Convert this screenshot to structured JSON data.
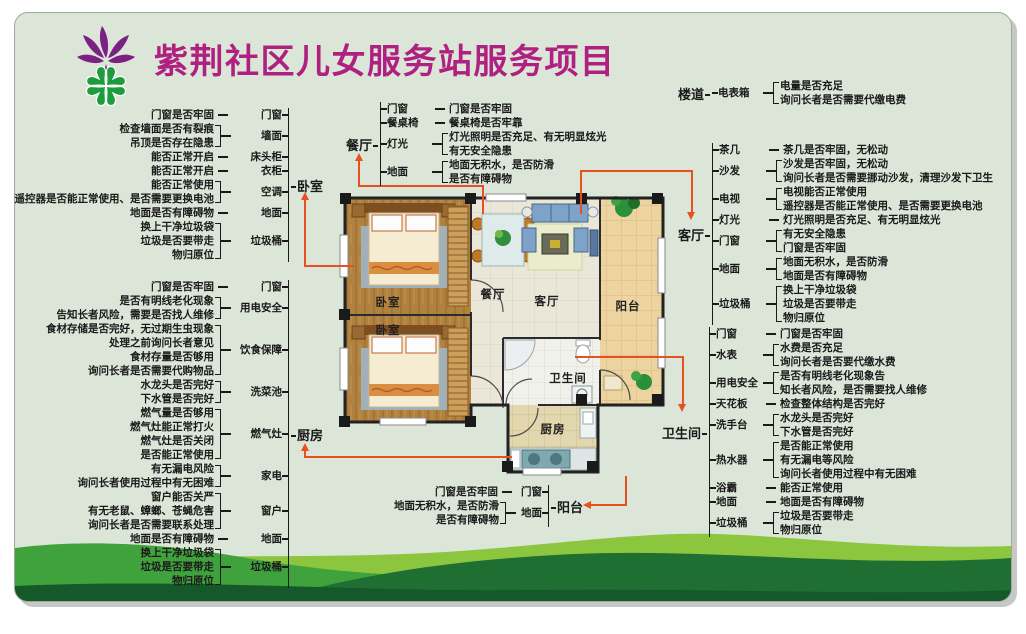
{
  "title": "紫荆社区儿女服务站服务项目",
  "colors": {
    "title": "#AF2080",
    "connector": "#E8511F",
    "poster_background": "#DBE6D8",
    "hills": [
      "#8CC63E",
      "#40A23C",
      "#1E6F31",
      "#155829"
    ],
    "logo_purple": "#7B2183",
    "logo_green": "#1C9C3C"
  },
  "floorplan": {
    "rooms": {
      "bedroom1": "卧室",
      "bedroom2": "卧室",
      "dining": "餐厅",
      "living": "客厅",
      "balcony": "阳台",
      "bathroom": "卫生间",
      "kitchen": "厨房"
    }
  },
  "sections": [
    {
      "id": "bedroom",
      "label": "卧室",
      "groups": [
        {
          "category": "门窗",
          "items": [
            "门窗是否牢固"
          ]
        },
        {
          "category": "墙面",
          "items": [
            "检查墙面是否有裂痕",
            "吊顶是否存在隐患"
          ]
        },
        {
          "category": "床头柜",
          "items": [
            "能否正常开启"
          ]
        },
        {
          "category": "衣柜",
          "items": [
            "能否正常开启"
          ]
        },
        {
          "category": "空调",
          "items": [
            "能否正常使用",
            "遥控器是否能正常使用、是否需要更换电池"
          ]
        },
        {
          "category": "地面",
          "items": [
            "地面是否有障碍物"
          ]
        },
        {
          "category": "垃圾桶",
          "items": [
            "换上干净垃圾袋",
            "垃圾是否要带走",
            "物归原位"
          ]
        }
      ]
    },
    {
      "id": "kitchen",
      "label": "厨房",
      "groups": [
        {
          "category": "门窗",
          "items": [
            "门窗是否牢固"
          ]
        },
        {
          "category": "用电安全",
          "items": [
            "是否有明线老化现象",
            "告知长者风险，需要是否找人维修"
          ]
        },
        {
          "category": "饮食保障",
          "items": [
            "食材存储是否完好，无过期生虫现象",
            "处理之前询问长者意见",
            "食材存量是否够用",
            "询问长者是否需要代购物品"
          ]
        },
        {
          "category": "洗菜池",
          "items": [
            "水龙头是否完好",
            "下水管是否完好"
          ]
        },
        {
          "category": "燃气灶",
          "items": [
            "燃气量是否够用",
            "燃气灶能正常打火",
            "燃气灶是否关闭",
            "是否能正常使用"
          ]
        },
        {
          "category": "家电",
          "items": [
            "有无漏电风险",
            "询问长者使用过程中有无困难"
          ]
        },
        {
          "category": "窗户",
          "items": [
            "窗户能否关严",
            "有无老鼠、蟑螂、苍蝇危害",
            "询问长者是否需要联系处理"
          ]
        },
        {
          "category": "地面",
          "items": [
            "地面是否有障碍物"
          ]
        },
        {
          "category": "垃圾桶",
          "items": [
            "换上干净垃圾袋",
            "垃圾是否要带走",
            "物归原位"
          ]
        }
      ]
    },
    {
      "id": "dining",
      "label": "餐厅",
      "groups": [
        {
          "category": "门窗",
          "items": [
            "门窗是否牢固"
          ]
        },
        {
          "category": "餐桌椅",
          "items": [
            "餐桌椅是否牢靠"
          ]
        },
        {
          "category": "灯光",
          "items": [
            "灯光照明是否充足、有无明显炫光",
            "有无安全隐患"
          ]
        },
        {
          "category": "地面",
          "items": [
            "地面无积水，是否防滑",
            "是否有障碍物"
          ]
        }
      ]
    },
    {
      "id": "corridor",
      "label": "楼道",
      "groups": [
        {
          "category": "电表箱",
          "items": [
            "电量是否充足",
            "询问长者是否需要代缴电费"
          ]
        }
      ]
    },
    {
      "id": "living",
      "label": "客厅",
      "groups": [
        {
          "category": "茶几",
          "items": [
            "茶几是否牢固，无松动"
          ]
        },
        {
          "category": "沙发",
          "items": [
            "沙发是否牢固，无松动",
            "询问长者是否需要挪动沙发，清理沙发下卫生"
          ]
        },
        {
          "category": "电视",
          "items": [
            "电视能否正常使用",
            "遥控器是否能正常使用、是否需要更换电池"
          ]
        },
        {
          "category": "灯光",
          "items": [
            "灯光照明是否充足、有无明显炫光"
          ]
        },
        {
          "category": "门窗",
          "items": [
            "有无安全隐患",
            "门窗是否牢固"
          ]
        },
        {
          "category": "地面",
          "items": [
            "地面无积水，是否防滑",
            "地面是否有障碍物"
          ]
        },
        {
          "category": "垃圾桶",
          "items": [
            "换上干净垃圾袋",
            "垃圾是否要带走",
            "物归原位"
          ]
        }
      ]
    },
    {
      "id": "bathroom",
      "label": "卫生间",
      "groups": [
        {
          "category": "门窗",
          "items": [
            "门窗是否牢固"
          ]
        },
        {
          "category": "水表",
          "items": [
            "水费是否充足",
            "询问长者是否要代缴水费"
          ]
        },
        {
          "category": "用电安全",
          "items": [
            "是否有明线老化现象告",
            "知长者风险，是否需要找人维修"
          ]
        },
        {
          "category": "天花板",
          "items": [
            "检查整体结构是否完好"
          ]
        },
        {
          "category": "洗手台",
          "items": [
            "水龙头是否完好",
            "下水管是否完好"
          ]
        },
        {
          "category": "热水器",
          "items": [
            "是否能正常使用",
            "有无漏电等风险",
            "询问长者使用过程中有无困难"
          ]
        },
        {
          "category": "浴霸",
          "items": [
            "能否正常使用"
          ]
        },
        {
          "category": "地面",
          "items": [
            "地面是否有障碍物"
          ]
        },
        {
          "category": "垃圾桶",
          "items": [
            "垃圾是否要带走",
            "物归原位"
          ]
        }
      ]
    },
    {
      "id": "balcony",
      "label": "阳台",
      "groups": [
        {
          "category": "门窗",
          "items": [
            "门窗是否牢固"
          ]
        },
        {
          "category": "地面",
          "items": [
            "地面无积水，是否防滑",
            "是否有障碍物"
          ]
        }
      ]
    }
  ]
}
